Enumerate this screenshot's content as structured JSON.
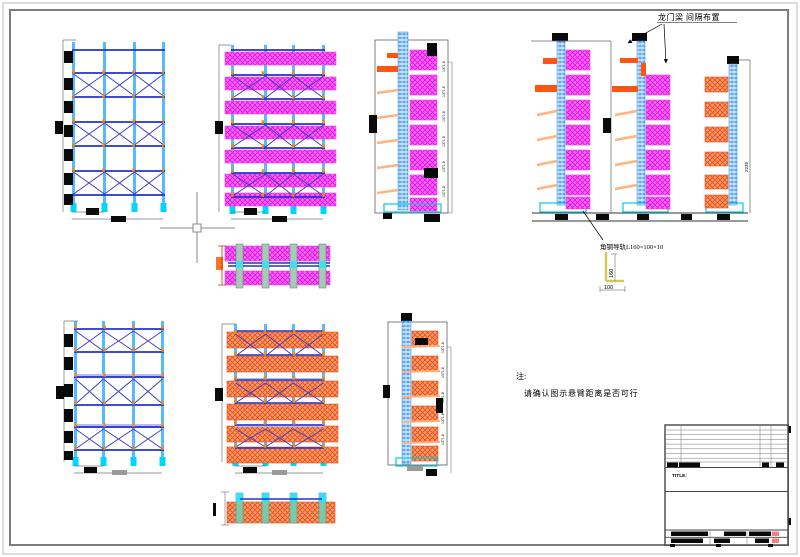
{
  "sheet": {
    "annotations": {
      "gantry_beam_note": "龙门梁  间隔布置",
      "rail_note": "角钢导轨L160×100×10",
      "rail_height_dim": "160",
      "rail_width_dim": "100",
      "rack_height_dim": "2235",
      "level_pitch_dim": "1371.8",
      "note_prefix": "注:",
      "note_text": "请确认图示悬臂距离是否可行"
    },
    "title_block": {
      "title_label": "TITLE:"
    },
    "colors": {
      "load_magenta": "#ff66ff",
      "load_orange": "#ff9a66",
      "frame_beam_blue": "#2233cc",
      "column_cyan": "#55bbff",
      "upright_hatch_cyan": "#aadcff",
      "arm_highlight_orange": "#ff5511",
      "arm_light_orange": "#ffb380",
      "connector_orange": "#ff8800",
      "rail_highlight_yellow": "#e6d84a",
      "redacted_text_black": "#0a0a0a",
      "title_block_pink": "#f08080"
    }
  }
}
